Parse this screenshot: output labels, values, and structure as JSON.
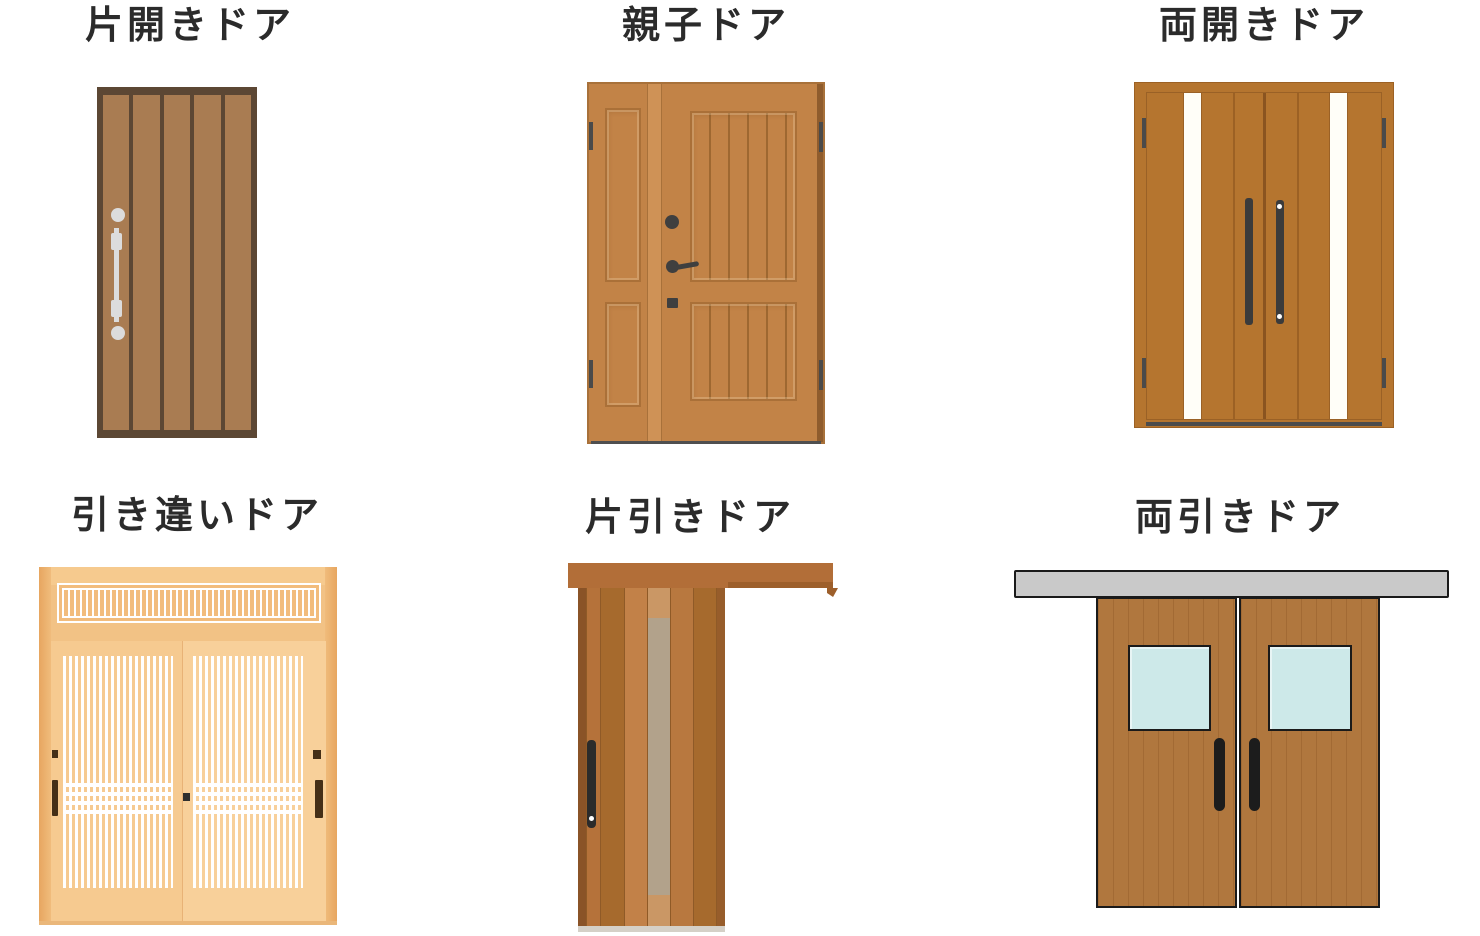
{
  "page": {
    "background": "#ffffff",
    "title_color": "#2b2b2b"
  },
  "doors": [
    {
      "id": "single-swing",
      "label": "片開きドア"
    },
    {
      "id": "parent-child",
      "label": "親子ドア"
    },
    {
      "id": "double-swing",
      "label": "両開きドア"
    },
    {
      "id": "sliding-bypass",
      "label": "引き違いドア"
    },
    {
      "id": "single-sliding",
      "label": "片引きドア"
    },
    {
      "id": "double-sliding",
      "label": "両引きドア"
    }
  ],
  "palette": {
    "door1_frame": "#5c4734",
    "door1_plank": "#a97c52",
    "door1_hardware_silver": "#dcdcdc",
    "door2_leaf": "#c28347",
    "door2_panel_line": "#9e6831",
    "door2_stile": "#cf9256",
    "door2_shadow": "#8f5c2d",
    "door2_hardware": "#3f3f3f",
    "door3_leaf": "#b5752f",
    "door3_glass_stripe": "#fffef8",
    "door3_handle": "#3b3b3b",
    "door3_threshold": "#4c4c4c",
    "door4_frame": "#f2c285",
    "door4_panel": "#f7cd94",
    "door4_lattice_white": "#ffffff",
    "door4_handle": "#452f17",
    "door5_rail": "#b26e38",
    "door5_plank_dark": "#a66a2d",
    "door5_plank_light": "#c28148",
    "door5_glass": "#b2a28b",
    "door5_handle": "#2b2b2b",
    "door5_threshold": "#d5d0c7",
    "door6_rail": "#c9c9c9",
    "door6_door": "#b0773e",
    "door6_window": "#cde9e9",
    "door6_outline": "#1a1a1a"
  }
}
